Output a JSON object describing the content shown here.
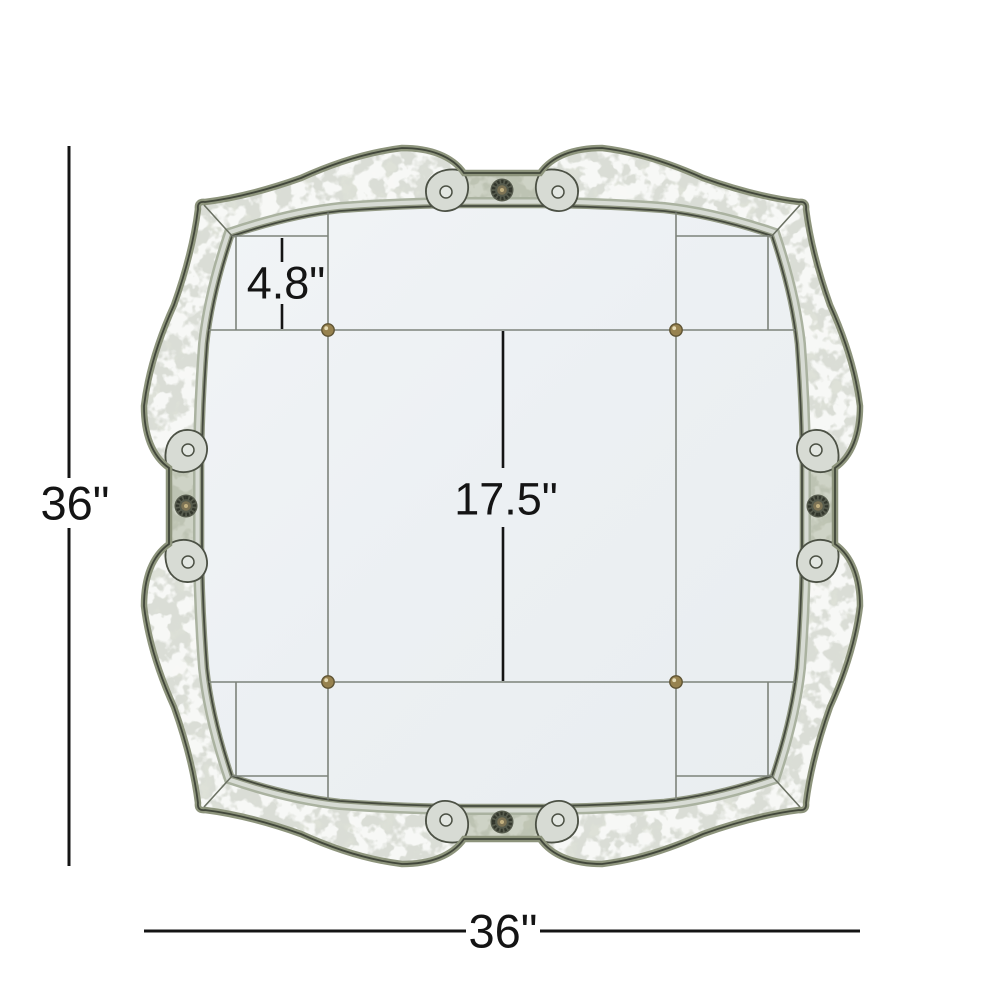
{
  "figure": {
    "type": "product-dimension-diagram",
    "subject": "antiqued quatrefoil wall mirror, front view"
  },
  "labels": {
    "overall_height": "36\"",
    "overall_width": "36\"",
    "border_width": "4.8\"",
    "center_panel": "17.5\""
  },
  "colors": {
    "background": "#ffffff",
    "dimension_line": "#141414",
    "frame_band_base": "#daddd6",
    "frame_edge_sage": "#8d947c",
    "frame_outline_dark": "#41463a",
    "mirror_field": "#edf1f4",
    "seam_line": "#7d837b",
    "brass_button": "#97824f",
    "medallion_dark": "#4a4f41"
  },
  "icons": {
    "medallion": "round antique rosette medallion at each side center",
    "button": "small brass rosette at mirror panel intersections"
  }
}
